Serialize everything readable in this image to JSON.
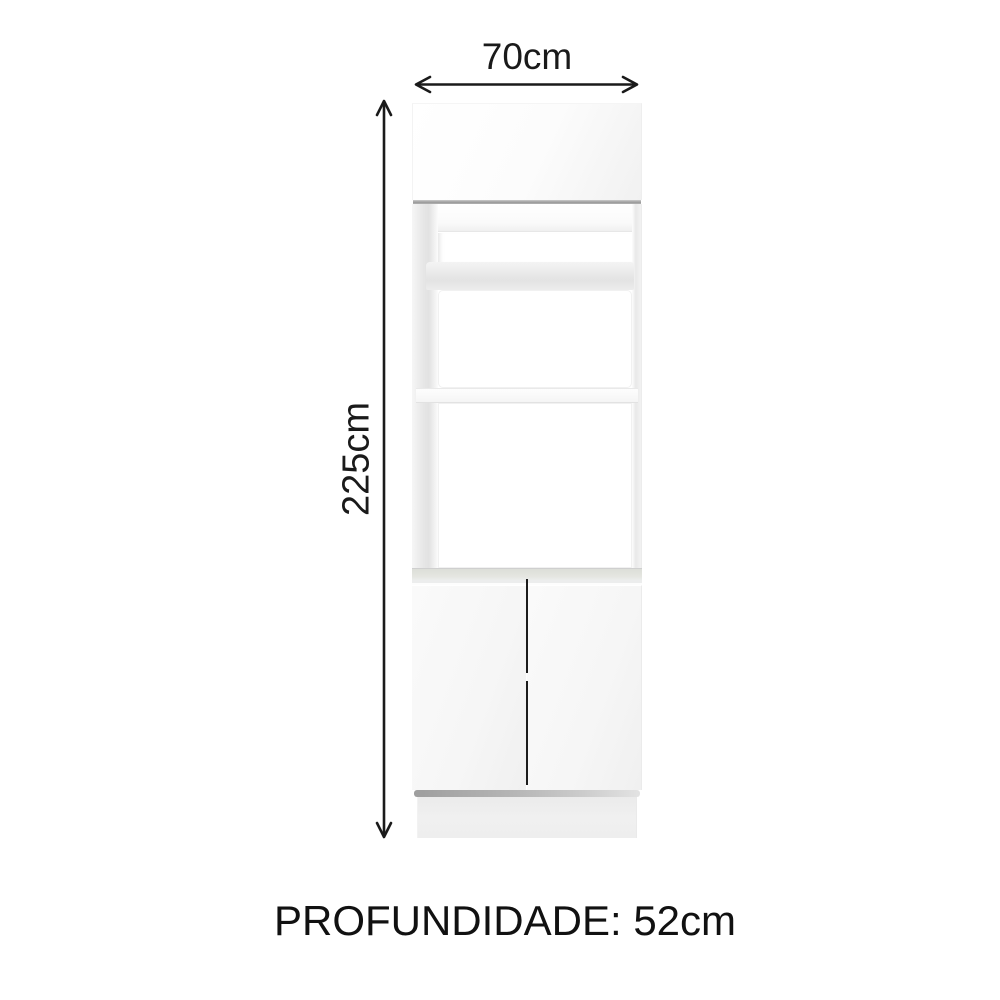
{
  "diagram": {
    "title": "cabinet-dimension-diagram",
    "width_label": "70cm",
    "height_label": "225cm",
    "depth_label": "PROFUNDIDADE: 52cm"
  },
  "icons": {
    "width_arrow": "double-headed-horizontal-arrow",
    "height_arrow": "double-headed-vertical-arrow"
  },
  "colors": {
    "background": "#ffffff",
    "dimension_lines": "#1a1a1a",
    "text": "#111111",
    "cabinet_body": "#f7f7f7",
    "seam_gray": "#9b9b9b",
    "counter_band": "#e4e5e0",
    "base_shadow": "#a6a6a6",
    "door_gap": "#1c1c1c"
  },
  "cabinet_structure": {
    "sections": [
      "top-door",
      "open-niche",
      "open-compartment-1",
      "open-compartment-2",
      "double-doors",
      "plinth"
    ]
  }
}
